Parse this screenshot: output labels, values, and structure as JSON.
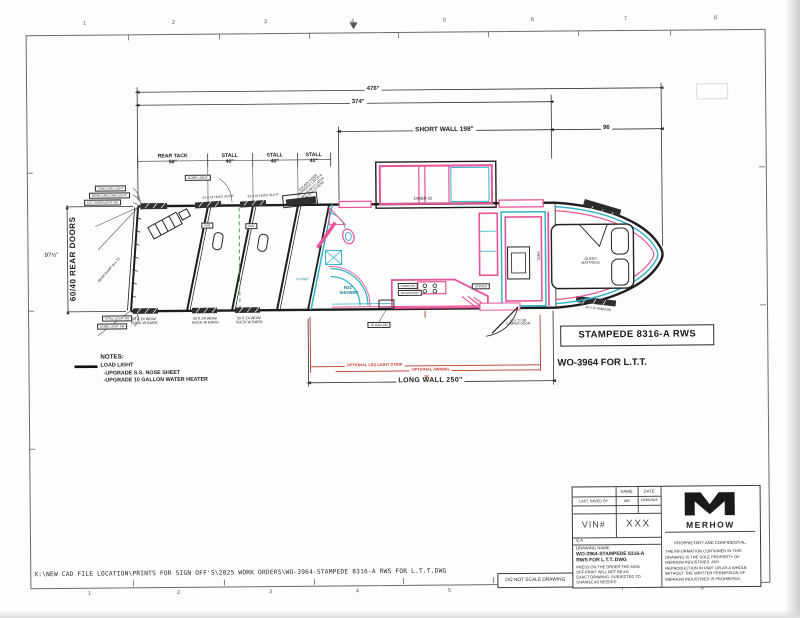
{
  "sheet": {
    "top_scale": [
      "1",
      "2",
      "3",
      "4",
      "5",
      "6",
      "7",
      "8"
    ],
    "bottom_scale": [
      "1",
      "2",
      "3",
      "4",
      "5",
      "6",
      "7",
      "8"
    ]
  },
  "dimensions": {
    "overall": "476\"",
    "floor": "374\"",
    "short_wall": "SHORT WALL 198\"",
    "nose": "96",
    "rear_height": "97½\"",
    "long_wall": "LONG WALL 250\"",
    "awning_len": "16'"
  },
  "callouts": {
    "model_box": "STAMPEDE 8316-A RWS",
    "work_order": "WO-3964 FOR L.T.T."
  },
  "notes": {
    "heading": "NOTES:",
    "items": [
      "LOAD LIGHT",
      "-UPGRADE S.S. NOSE SHEET",
      "-UPGRADE 10 GALLON WATER HEATER"
    ]
  },
  "optional": {
    "led": "OPTIONAL LED LIGHT STRIP",
    "awning": "OPTIONAL AWNING"
  },
  "plan": {
    "rear_doors": "60/40 REAR DOORS",
    "rear_ramp": "REAR RAMP W X 22",
    "rear_tack_label": "REAR TACK",
    "rear_tack_size": "56\"",
    "stall_label": "STALL",
    "stall_size": "40\"",
    "fan": "FAN",
    "dome_light": "DOME LIGHT",
    "light_sw_1": "CAM LOAD LIGHT",
    "light_sw_2": "REAR CAM LOAD LIGHT",
    "light_sw_3": "EXT. WORKLIGHT SW",
    "light_sw_4": "STALL LIGHT SW",
    "light_sw_5": "DOME LIGHT SW",
    "huck_slider": "33 X 24 HUCK SLD.R",
    "stall_window_1": "30 X 24 WDW.",
    "stall_window_2": "HUCK W BARS",
    "escape_door": [
      "ESCAPE DOOR",
      "W/PADDLE LATCH &",
      "BUTTERFLY LATCH",
      "IN 30 X 24 WDW."
    ],
    "slide_label": "DINER-22",
    "shower_1": "R32\"",
    "shower_2": "SHOWER",
    "closet": "CLOSET",
    "cooktop": "COOKTOP",
    "micro": "MICRO/CONV",
    "stereo": "STEREO",
    "sofa": "SOFA",
    "ten_gallon": "10 GALLON",
    "camper_door_1": "66 X 72 3/8",
    "camper_door_2": "CAMPER DOOR",
    "queen_1": "QUEEN",
    "queen_2": "MATTRESS",
    "nose_window_top_1": "30 X 22 SCREEN",
    "nose_window_top_2": "WINDOW",
    "nose_window_bottom": "30 X 22 WINDOW"
  },
  "title_block": {
    "col_name": "NAME",
    "col_date": "DATE",
    "last_saved_by": "LAST SAVED BY",
    "saved_name": "AM",
    "saved_date": "10/30/2025",
    "vin_label": "VIN#",
    "vin_value": "XXX",
    "qa": "Q.A.",
    "drawing_name_label": "DRAWING NAME:",
    "drawing_name_1": "WO-3964-STAMPEDE 8316-A",
    "drawing_name_2": "RWS FOR L.T.T..DWG",
    "disclaimer": [
      "PRESS ON THE ORDER THE SIGN",
      "OFF PRINT WILL NOT BE AN",
      "EXACT DRAWING. SUBJECTED TO",
      "CHANGE AS NEEDED"
    ],
    "brand": "MERHOW",
    "proprietary_title": "PROPRIETARY AND CONFIDENTIAL.",
    "proprietary_lines": [
      "THE INFORMATION CONTAINED IN THIS",
      "DRAWING IS THE SOLE PROPERTY OF",
      "MERHOW INDUSTRIES.  ANY",
      "REPRODUCTION IN PART OR AS A WHOLE",
      "WITHOUT THE WRITTEN PERMISSION OF",
      "MERHOW INDUSTRIES IS PROHIBITED."
    ],
    "do_not_scale": "DO NOT SCALE DRAWING"
  },
  "footer": {
    "file_path": "X:\\NEW CAD FILE LOCATION\\PRINTS FOR SIGN OFF'S\\2025 WORK ORDERS\\WO-3964-STAMPEDE 8316-A RWS FOR L.T.T.DWG"
  },
  "colors": {
    "accent_pink": "#e8559a",
    "accent_cyan": "#31b4c8",
    "dim_red": "#c0392b",
    "line": "#1d1d1d",
    "center_dash_green": "#3a9a3a"
  }
}
